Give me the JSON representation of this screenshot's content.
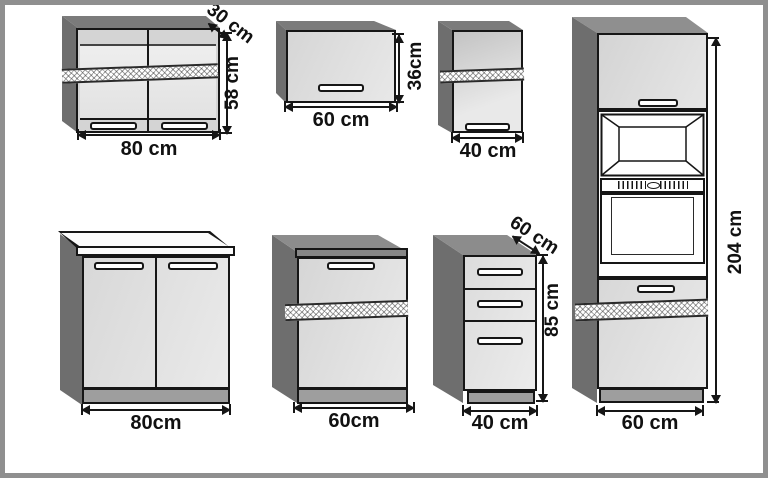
{
  "units": "cm",
  "colors": {
    "outline": "#161616",
    "frame_border": "#8f8f8f",
    "side_panel": "#6e6e6e",
    "top_panel_dark": "#7b7b7b",
    "top_panel_mid": "#8c8c8c",
    "door_light": "#dcdcdc",
    "plinth": "#9e9e9e",
    "worktop_white": "#fbfbfb",
    "background": "#ffffff"
  },
  "cabinets": {
    "wall_80": {
      "width_label": "80 cm",
      "height_label": "58 cm",
      "depth_label": "30 cm"
    },
    "wall_60": {
      "width_label": "60 cm",
      "height_label": "36cm"
    },
    "wall_40": {
      "width_label": "40 cm"
    },
    "base_80": {
      "width_label": "80cm"
    },
    "base_60": {
      "width_label": "60cm"
    },
    "drawer_40": {
      "width_label": "40 cm",
      "height_label": "85 cm",
      "depth_label": "60 cm"
    },
    "tall_60": {
      "width_label": "60 cm",
      "height_label": "204 cm"
    }
  }
}
